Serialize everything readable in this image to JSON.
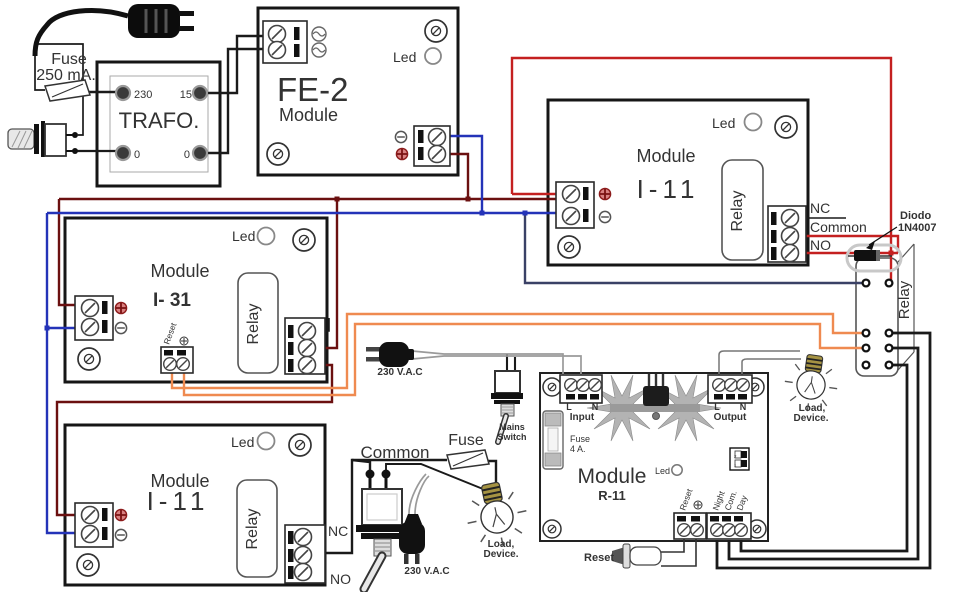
{
  "diagram": {
    "power": {
      "fuse_line1": "Fuse",
      "fuse_line2": "250 mA."
    },
    "trafo": {
      "title": "TRAFO.",
      "t_230": "230",
      "t_15": "15",
      "t_0l": "0",
      "t_0r": "0"
    },
    "fe2": {
      "model": "FE-2",
      "title": "Module",
      "led": "Led"
    },
    "i11_top": {
      "title": "Module",
      "model": "I-11",
      "led": "Led",
      "relay": "Relay",
      "nc": "NC",
      "common": "Common",
      "no": "NO"
    },
    "diode": {
      "name_line1": "Diodo",
      "name_line2": "1N4007"
    },
    "ext_relay": {
      "label": "Relay"
    },
    "i31": {
      "title": "Module",
      "model": "I- 31",
      "led": "Led",
      "relay": "Relay",
      "reset": "Reset"
    },
    "i11_bottom": {
      "title": "Module",
      "model": "I-11",
      "led": "Led",
      "relay": "Relay",
      "nc": "NC",
      "no": "NO"
    },
    "switch_area": {
      "common": "Common",
      "fuse": "Fuse",
      "vac": "230 V.A.C",
      "load_line1": "Load,",
      "load_line2": "Device."
    },
    "mains": {
      "vac": "230 V.A.C",
      "switch_line1": "Mains",
      "switch_line2": "Switch"
    },
    "r11": {
      "title": "Module",
      "model": "R-11",
      "led": "Led",
      "input_l": "L",
      "input_n": "N",
      "input": "Input",
      "output_l": "L",
      "output_n": "N",
      "output": "Output",
      "fuse_line1": "Fuse",
      "fuse_line2": "4 A.",
      "reset": "Reset",
      "night": "Night",
      "com": "Com.",
      "day": "Day",
      "dip_1": "1",
      "dip_2": "2",
      "reset_button": "Reset",
      "load_line1": "Load,",
      "load_line2": "Device."
    }
  },
  "colors": {
    "black": "#1a1a1a",
    "dark_red": "#6b1010",
    "red": "#c42020",
    "blue": "#2433b8",
    "navy": "#3a4166",
    "orange": "#ef8a50",
    "cord": "#9a9a9a"
  }
}
